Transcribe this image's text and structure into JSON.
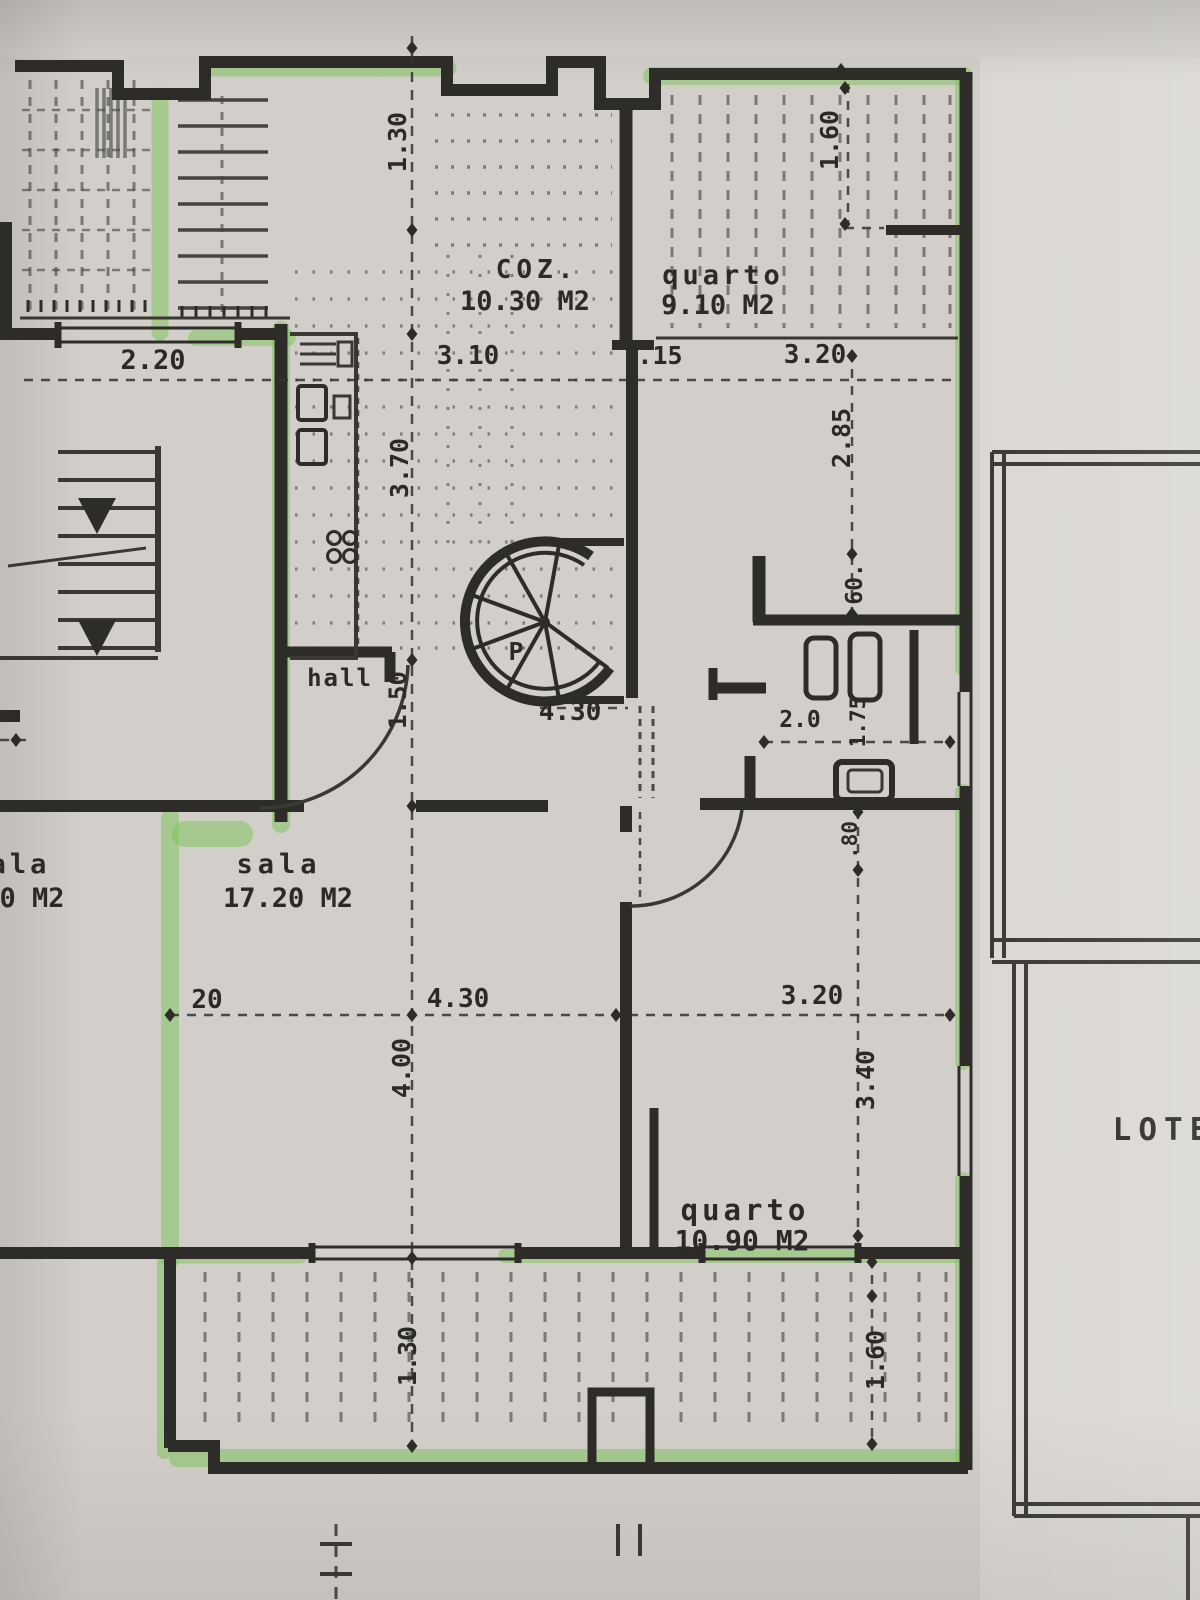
{
  "plan": {
    "rooms": {
      "coz": {
        "name": "COZ.",
        "area": "10.30 M2"
      },
      "quarto1": {
        "name": "quarto",
        "area": "9.10 M2"
      },
      "sala": {
        "name": "sala",
        "area": "17.20 M2"
      },
      "sala_left": {
        "name": "ala",
        "area": "0 M2"
      },
      "quarto2": {
        "name": "quarto",
        "area": "10.90 M2"
      },
      "hall": {
        "name": "hall"
      }
    },
    "stair_label": "P",
    "site_label": "LOTE",
    "dims": {
      "d220": "2.20",
      "d130_top": "1.30",
      "d160_top": "1.60",
      "d310": "3.10",
      "d15": ".15",
      "d320_top": "3.20",
      "d370": "3.70",
      "d285": "2.85",
      "d60": "60.",
      "d150": "1.50",
      "d430_mid": "4.30",
      "d20_small": "2.0",
      "d175": "1.75",
      "d80": ".80",
      "d20": "20",
      "d430_sala": "4.30",
      "d400": "4.00",
      "d320_right": "3.20",
      "d340": "3.40",
      "d130_bottom": "1.30",
      "d160_bottom": "1.60"
    },
    "colors": {
      "paper": "#d2cfca",
      "ink": "#2e2c28",
      "highlighter": "#7fc45c"
    }
  }
}
